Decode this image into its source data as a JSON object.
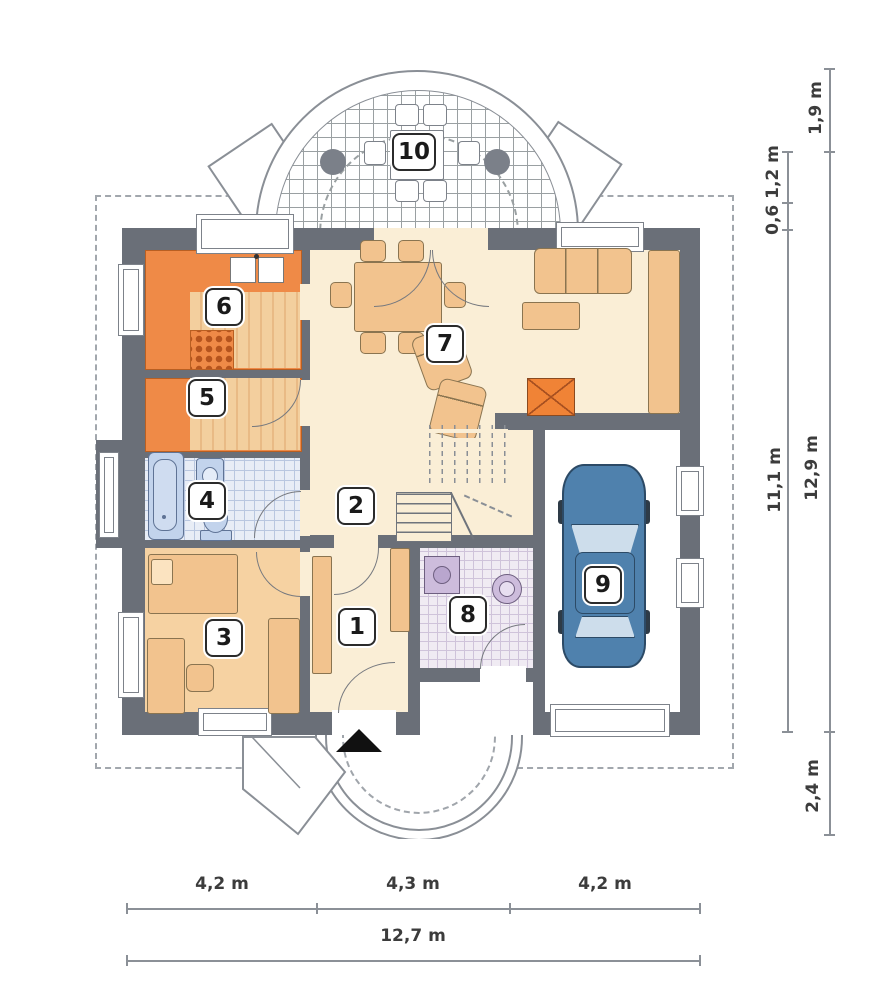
{
  "diagram": {
    "type": "house-floor-plan",
    "floor_rooms": [
      {
        "number": "1"
      },
      {
        "number": "2"
      },
      {
        "number": "3"
      },
      {
        "number": "4"
      },
      {
        "number": "5"
      },
      {
        "number": "6"
      },
      {
        "number": "7"
      },
      {
        "number": "8"
      },
      {
        "number": "9"
      },
      {
        "number": "10"
      }
    ],
    "dimensions": {
      "right_inner_top": "0,6 1,2 m",
      "right_inner_main": "11,1 m",
      "right_outer_top": "1,9 m",
      "right_outer_main": "12,9 m",
      "right_outer_bottom": "2,4 m",
      "bottom_left": "4,2 m",
      "bottom_middle": "4,3 m",
      "bottom_right": "4,2 m",
      "bottom_total": "12,7 m"
    },
    "colors": {
      "wall": "#6a6f78",
      "floor_cream": "#faeed6",
      "floor_wood": "#f3cf9e",
      "floor_bedroom": "#f6d2a2",
      "accent_orange": "#ef8a47",
      "furniture_tan": "#f2c38e",
      "bath_tile": "#e8edf6",
      "utility_tile": "#f0ebf3",
      "car_blue": "#4f81ad",
      "fireplace_orange": "#f08336",
      "outline_dash": "#a2a7ad"
    }
  }
}
